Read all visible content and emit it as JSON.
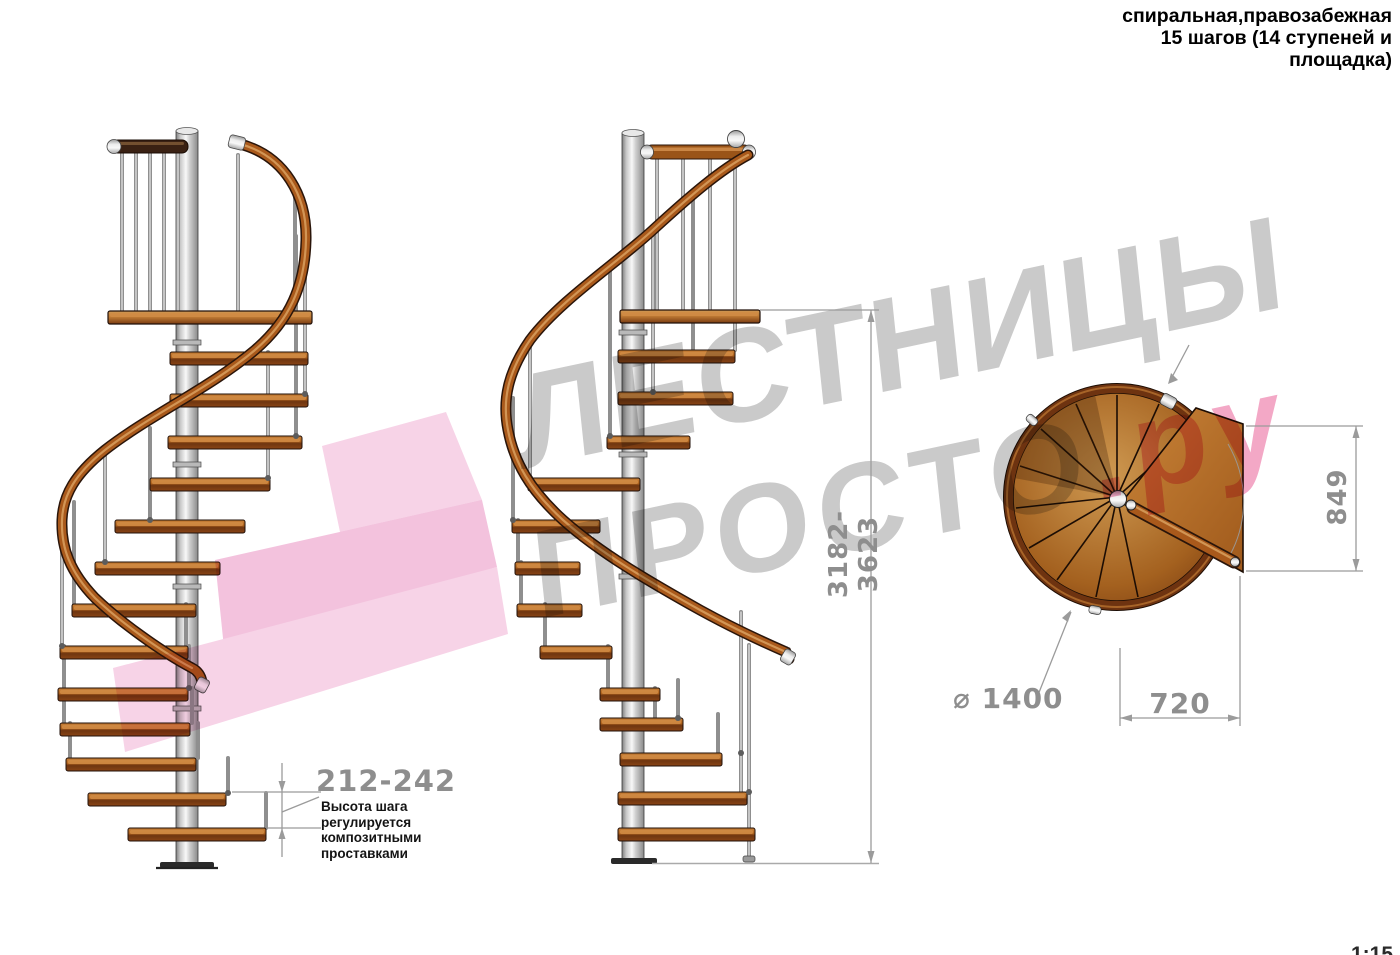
{
  "header": {
    "title_lines": "спиральная,правозабежная\n15 шагов (14 ступеней и\nплощадка)"
  },
  "watermark": {
    "line1": "ЛЕСТНИЦЫ",
    "line2_gray": "ПРОСТО",
    "line2_pink": ".ру",
    "gray_color": "#cacaca",
    "pink_color": "#f3a8c6",
    "ribbon_pink_light": "#f7d3e7",
    "ribbon_pink_mid": "#f3c2dd",
    "ribbon_pink_dark": "#edb3d3"
  },
  "dimensions": {
    "step_height_range": "212-242",
    "total_height_range": "3182-3623",
    "platform_side": "849",
    "platform_width": "720",
    "diameter": "⌀ 1400"
  },
  "annotations": {
    "step_note": "Высота шага\nрегулируется\nкомпозитными\nпроставками"
  },
  "scale_label": "1:15",
  "colors": {
    "wood_light": "#c8823b",
    "wood_dark": "#6e3510",
    "rail_wood": "#a9591b",
    "metal_pole": "#d9d9d9",
    "dimension_gray": "#9b9b9b",
    "text_black": "#000000"
  }
}
